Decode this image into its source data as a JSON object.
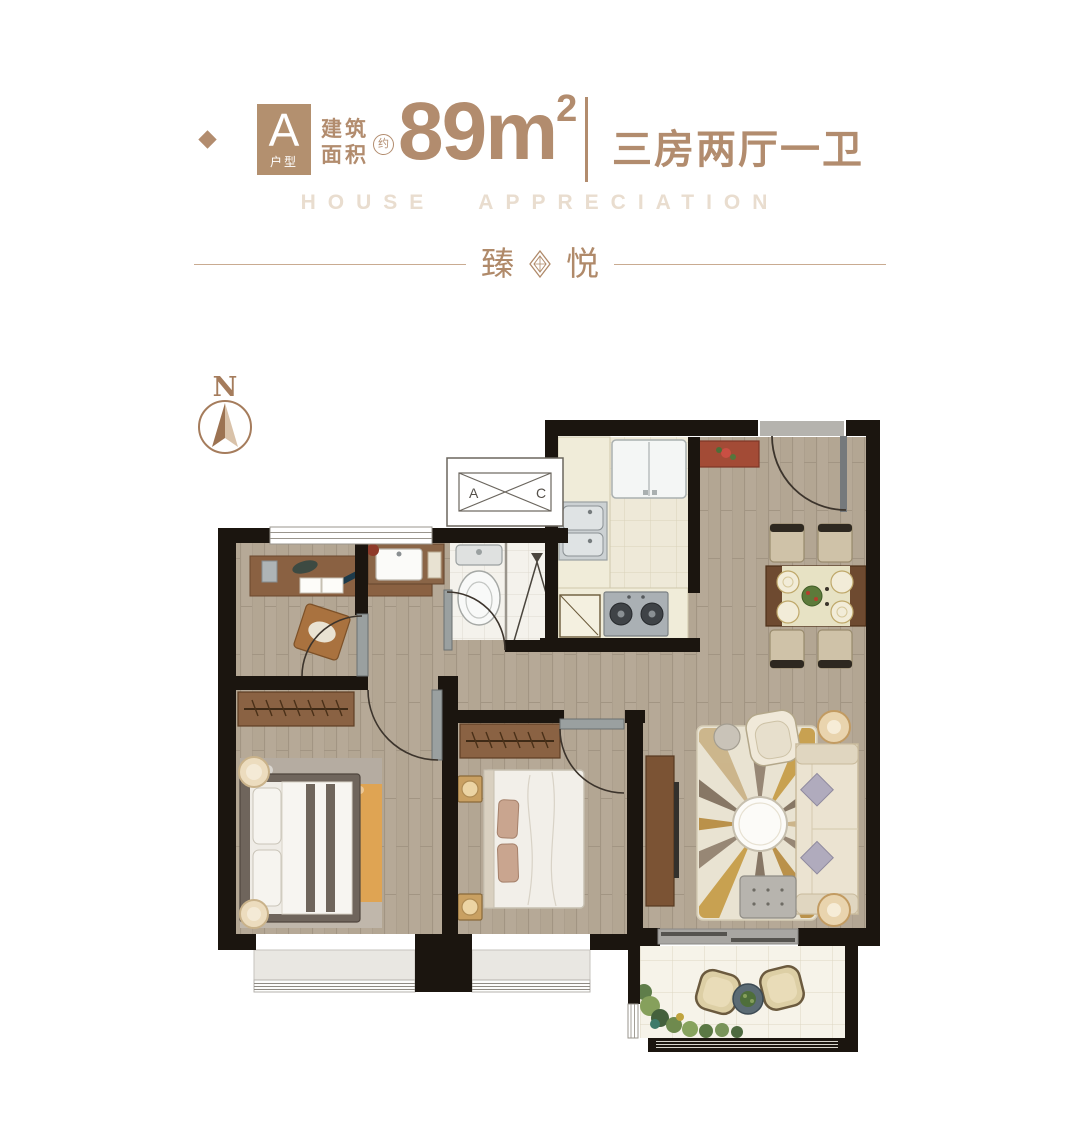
{
  "header": {
    "unit_type": "A",
    "unit_type_label": "户型",
    "area_label_line1": "建筑",
    "area_label_line2": "面积",
    "area_approx": "约",
    "area_value": "89",
    "area_unit": "m",
    "area_sup": "2",
    "layout": "三房两厅一卫",
    "watermark": "HOUSE APPRECIATION",
    "title_char1": "臻",
    "title_char2": "悦",
    "accent_color": "#b28c6e",
    "watermark_color": "#e9ddcf"
  },
  "compass": {
    "label": "N"
  },
  "plan": {
    "ac_unit": {
      "label_left": "A",
      "label_right": "C"
    },
    "colors": {
      "wall": "#1b150f",
      "wood_floor": "#b6a997",
      "kitchen_tile": "#eee9d8",
      "bath_tile": "#f4f2ec",
      "balcony_tile": "#f6f3e9",
      "bay_sill": "#e9e7e2",
      "furniture_wood": "#8a6243",
      "entry_cabinet_red": "#a34b36",
      "rug_orange": "#dfa453",
      "door_leaf": "#9aa0a0"
    }
  }
}
